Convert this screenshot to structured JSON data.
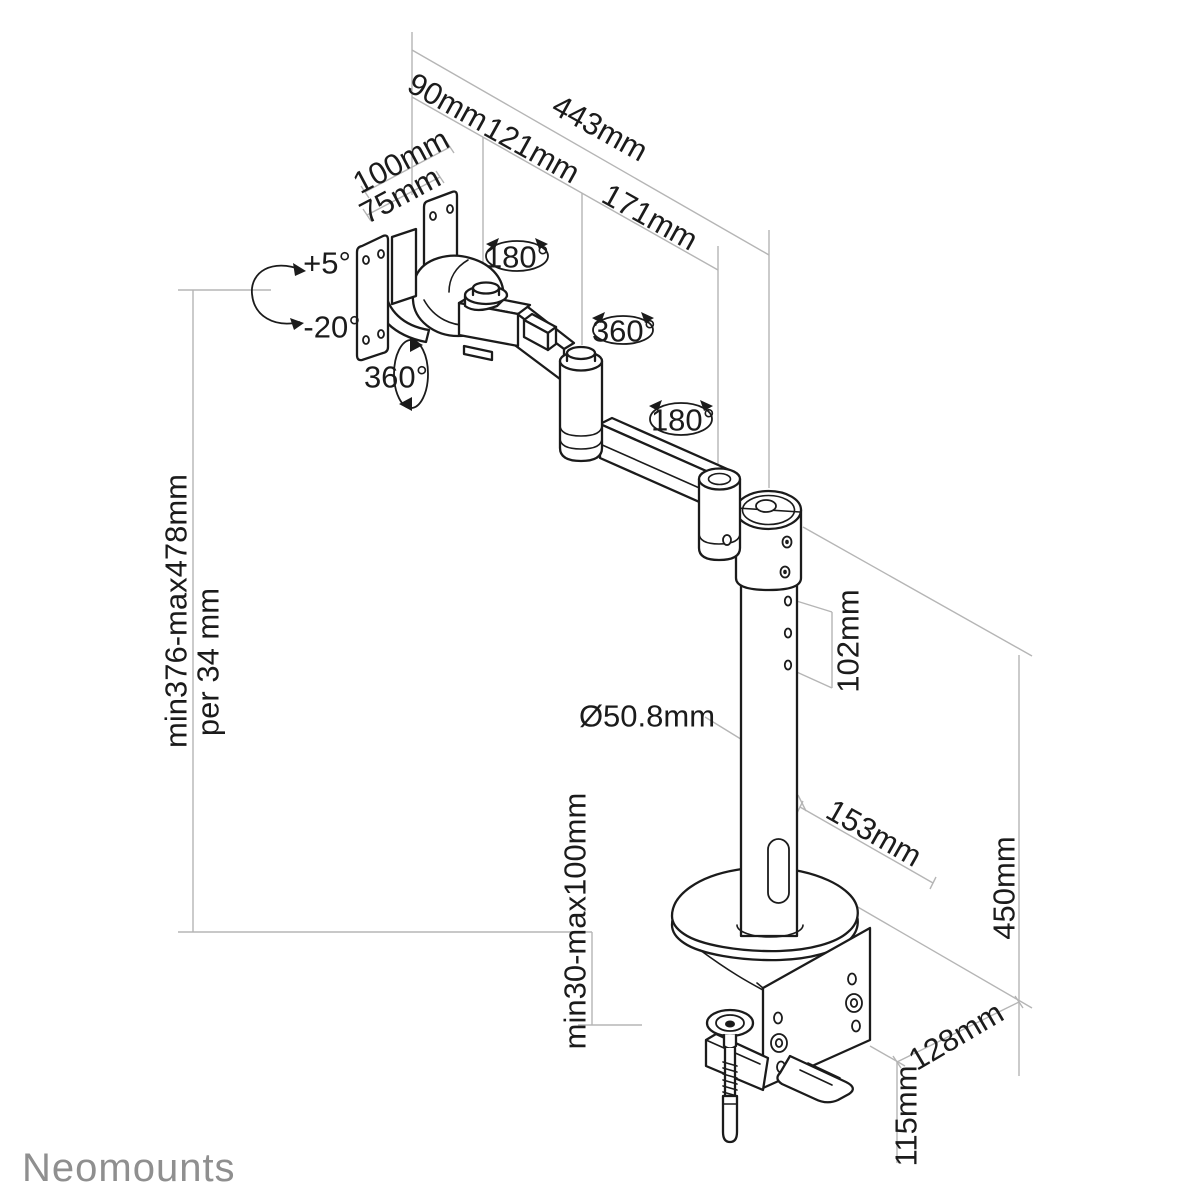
{
  "logo": {
    "text": "Neomounts"
  },
  "colors": {
    "line": "#1b1b1b",
    "dimension": "#b5b5b5",
    "logo": "#8f8f8f",
    "background": "#ffffff"
  },
  "labels": {
    "arm_total": "443mm",
    "arm_seg1": "90mm",
    "arm_seg2": "121mm",
    "arm_seg3": "171mm",
    "vesa_100": "100mm",
    "vesa_75": "75mm",
    "tilt_up": "+5°",
    "tilt_down": "-20°",
    "swivel_joint1": "180°",
    "rotate_vesa": "360°",
    "swivel_joint2": "360°",
    "swivel_joint3": "180°",
    "height_range": "min376-max478mm",
    "height_step": "per 34 mm",
    "pole_diameter": "Ø50.8mm",
    "pin_spacing": "102mm",
    "base_depth": "153mm",
    "pole_height": "450mm",
    "clamp_thickness": "min30-max100mm",
    "clamp_depth": "128mm",
    "clamp_height": "115mm"
  }
}
